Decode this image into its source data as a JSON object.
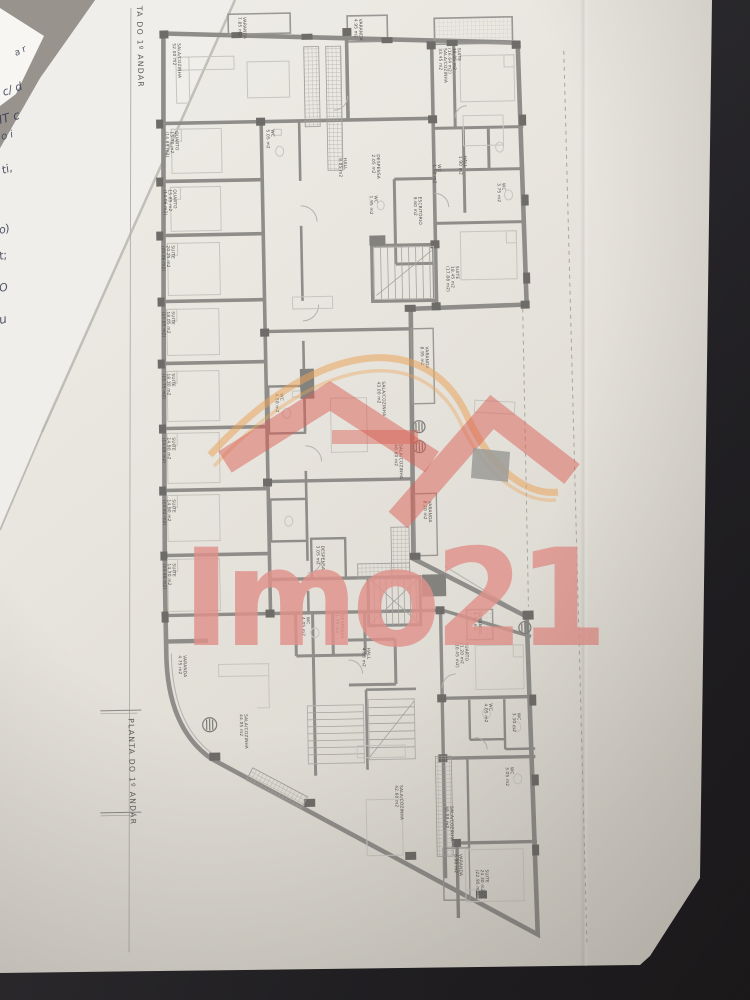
{
  "scene": {
    "description": "Photograph of a printed architectural floor plan lying on a dark table, red agency watermark over the drawing"
  },
  "plan": {
    "title_bottom": "PLANTA DO 1º ANDAR",
    "title_top_partial": "TA DO 1º ANDAR"
  },
  "watermark": {
    "text": "Imo21",
    "text_color": "#e0928b",
    "roof_color": "#d96055",
    "swoosh_color": "#eaa45c"
  },
  "handwriting": [
    {
      "text": "a r",
      "x": 16,
      "y": 56,
      "size": 9,
      "rot": -26
    },
    {
      "text": "c/ d",
      "x": 4,
      "y": 96,
      "size": 11,
      "rot": -20
    },
    {
      "text": "IT c",
      "x": 0,
      "y": 124,
      "size": 12,
      "rot": -15
    },
    {
      "text": "o i",
      "x": 2,
      "y": 140,
      "size": 10,
      "rot": -15
    },
    {
      "text": "ti,",
      "x": 3,
      "y": 174,
      "size": 11,
      "rot": -18
    },
    {
      "text": "o)",
      "x": 0,
      "y": 234,
      "size": 11,
      "rot": -15
    },
    {
      "text": "t;",
      "x": 0,
      "y": 260,
      "size": 11,
      "rot": -14
    },
    {
      "text": "O",
      "x": 0,
      "y": 292,
      "size": 11,
      "rot": -12
    },
    {
      "text": "u",
      "x": 0,
      "y": 324,
      "size": 12,
      "rot": -12
    }
  ],
  "rooms": [
    {
      "name": "VARANDA",
      "area": "7.85 m2",
      "x": 252,
      "y": 15
    },
    {
      "name": "SALA/COZINHA",
      "area": "52.00 m2",
      "x": 186,
      "y": 40
    },
    {
      "name": "VARANDA",
      "area": "4.95 m2",
      "x": 368,
      "y": 19
    },
    {
      "name": "SALA/COZINHA",
      "area": "33.45 m2",
      "x": 452,
      "y": 50
    },
    {
      "name": "SUITE",
      "area": "18.05 m2",
      "area2": "(16.64 m2)",
      "x": 466,
      "y": 50
    },
    {
      "name": "QUARTO",
      "area": "15.70 m2",
      "area2": "(14.89 m2)",
      "x": 182,
      "y": 128
    },
    {
      "name": "QUARTO",
      "area": "15.85 m2",
      "area2": "(14.06 m2)",
      "x": 179,
      "y": 186
    },
    {
      "name": "WC",
      "area": "5.05 m2",
      "x": 278,
      "y": 128
    },
    {
      "name": "HALL",
      "area": "9.05 m2",
      "x": 350,
      "y": 158
    },
    {
      "name": "DESPENSA",
      "area": "2.05 m2",
      "x": 383,
      "y": 155
    },
    {
      "name": "WC",
      "area": "1.95 m2",
      "x": 380,
      "y": 196
    },
    {
      "name": "WC",
      "area": "1.50 m2",
      "x": 444,
      "y": 166
    },
    {
      "name": "HALL",
      "area": "1.90 m2",
      "x": 470,
      "y": 158
    },
    {
      "name": "WC",
      "area": "3.75 m2",
      "x": 508,
      "y": 186
    },
    {
      "name": "ESCRITÓRIO",
      "area": "9.60 m2",
      "x": 424,
      "y": 198
    },
    {
      "name": "SUITE",
      "area": "20.25 m2",
      "area2": "(20.06 m2)",
      "x": 176,
      "y": 242
    },
    {
      "name": "SUITE",
      "area": "18.45 m2",
      "area2": "(17.88 m2)",
      "x": 460,
      "y": 268
    },
    {
      "name": "SUITE",
      "area": "18.05 m2",
      "area2": "(17.85 m2)",
      "x": 175,
      "y": 308
    },
    {
      "name": "SUITE",
      "area": "18.10 m2",
      "area2": "(15.75 m2)",
      "x": 174,
      "y": 370
    },
    {
      "name": "VARANDA",
      "area": "8.95 m2",
      "x": 428,
      "y": 348
    },
    {
      "name": "SALA/COZINHA",
      "area": "43.00 m2",
      "x": 384,
      "y": 382
    },
    {
      "name": "WC",
      "area": "4.50 m2",
      "x": 282,
      "y": 392
    },
    {
      "name": "SUITE",
      "area": "14.90 m2",
      "area2": "(14.08 m2)",
      "x": 173,
      "y": 434
    },
    {
      "name": "SALA/COZINHA",
      "area": "46.60 m2",
      "x": 400,
      "y": 445
    },
    {
      "name": "SUITE",
      "area": "14.90 m2",
      "area2": "(13.02 m2)",
      "x": 172,
      "y": 496
    },
    {
      "name": "VARANDA",
      "area": "8.20 m2",
      "x": 428,
      "y": 502
    },
    {
      "name": "DESPENSA",
      "area": "3.05 m2",
      "x": 320,
      "y": 545
    },
    {
      "name": "SUITE",
      "area": "14.70 m2",
      "area2": "(13.48 m2)",
      "x": 171,
      "y": 560
    },
    {
      "name": "VARANDA",
      "area": "4.75 m2",
      "x": 180,
      "y": 652
    },
    {
      "name": "WC",
      "area": "4.05 m2",
      "x": 304,
      "y": 616
    },
    {
      "name": "DESPENSA",
      "area": "1.75 m2",
      "x": 338,
      "y": 614
    },
    {
      "name": "HALL",
      "area": "4.05 m2",
      "x": 364,
      "y": 648
    },
    {
      "name": "VARANDA",
      "area": "3.35 m2",
      "x": 476,
      "y": 614
    },
    {
      "name": "QUARTO",
      "area": "11.20 m2",
      "area2": "(10.45 m2)",
      "x": 462,
      "y": 644
    },
    {
      "name": "SALA/COZINHA",
      "area": "44.05 m2",
      "x": 240,
      "y": 712
    },
    {
      "name": "WC",
      "area": "4.05 m2",
      "x": 485,
      "y": 706
    },
    {
      "name": "WC",
      "area": "3.30 m2",
      "x": 513,
      "y": 716
    },
    {
      "name": "WC",
      "area": "3.05 m2",
      "x": 505,
      "y": 770
    },
    {
      "name": "SALA/COZINHA",
      "area": "42.60 m2",
      "x": 394,
      "y": 786
    },
    {
      "name": "SALA/COZINHA",
      "area": "48.00 m2",
      "x": 444,
      "y": 808
    },
    {
      "name": "VARANDA",
      "area": "6.90 m2",
      "x": 452,
      "y": 856
    },
    {
      "name": "SUITE",
      "area": "24.30 m2",
      "area2": "(22.95 m2)",
      "x": 478,
      "y": 872
    }
  ]
}
